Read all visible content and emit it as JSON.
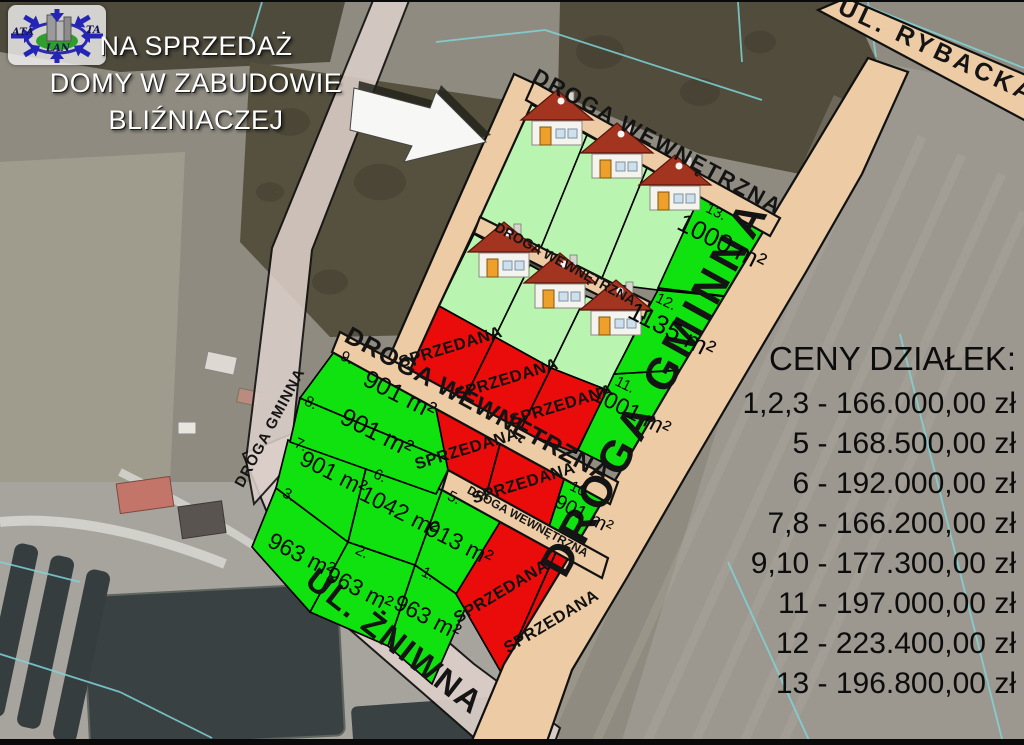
{
  "ad": {
    "line1": "NA SPRZEDAŻ",
    "line2": "DOMY W ZABUDOWIE",
    "line3": "BLIŹNIACZEJ"
  },
  "logo": {
    "ata": "ATA",
    "ta": "TA",
    "lan": "LAN"
  },
  "price_list": {
    "title": "CENY DZIAŁEK:",
    "items": [
      {
        "plots": "1,2,3",
        "price": "166.000,00 zł"
      },
      {
        "plots": "5",
        "price": "168.500,00 zł"
      },
      {
        "plots": "6",
        "price": "192.000,00 zł"
      },
      {
        "plots": "7,8",
        "price": "166.200,00 zł"
      },
      {
        "plots": "9,10",
        "price": "177.300,00 zł"
      },
      {
        "plots": "11",
        "price": "197.000,00 zł"
      },
      {
        "plots": "12",
        "price": "223.400,00 zł"
      },
      {
        "plots": "13",
        "price": "196.800,00 zł"
      }
    ]
  },
  "streets": [
    {
      "key": "zniwna",
      "name": "UL. ŻNIWNA"
    },
    {
      "key": "gminnaL",
      "name": "DROGA GMINNA"
    },
    {
      "key": "rybacka",
      "name": "UL. RYBACKA"
    },
    {
      "key": "gminnaR",
      "name": "DROGA GMINNA"
    },
    {
      "key": "rtop",
      "name": "DROGA WEWNĘTRZNA"
    },
    {
      "key": "r2",
      "name": "DROGA WEWNĘTRZNA"
    },
    {
      "key": "r3",
      "name": "DROGA WEWNĘTRZNA"
    },
    {
      "key": "r4",
      "name": "DROGA WEWNĘTRZNA"
    },
    {
      "key": "rleft",
      "name": ""
    }
  ],
  "sold_label": "SPRZEDANA",
  "plots": [
    {
      "id": "p1",
      "number": "1.",
      "area": "963 m²"
    },
    {
      "id": "p2",
      "number": "2.",
      "area": "963 m²"
    },
    {
      "id": "p3",
      "number": "3.",
      "area": "963 m²"
    },
    {
      "id": "p5",
      "number": "5.",
      "area": "913 m²"
    },
    {
      "id": "p6",
      "number": "6.",
      "area": "1042 m²"
    },
    {
      "id": "p7",
      "number": "7.",
      "area": "901 m²"
    },
    {
      "id": "p8",
      "number": "8.",
      "area": "901 m²"
    },
    {
      "id": "p9",
      "number": "9.",
      "area": "901 m²"
    },
    {
      "id": "p10",
      "number": "10.",
      "area": "901 m²"
    },
    {
      "id": "p11",
      "number": "11.",
      "area": "1001 m²"
    },
    {
      "id": "p12",
      "number": "12.",
      "area": "1135 m²"
    },
    {
      "id": "p13",
      "number": "13.",
      "area": "1000 m²"
    }
  ],
  "sold_plots": [
    {
      "id": "s1"
    },
    {
      "id": "s2"
    },
    {
      "id": "s3"
    },
    {
      "id": "s4"
    },
    {
      "id": "s5"
    },
    {
      "id": "s6"
    },
    {
      "id": "s7"
    }
  ],
  "colors": {
    "available": "#10e210",
    "sold": "#ea0b0b",
    "house_plot": "#b9f4b1",
    "road": "#edcba5",
    "road_light": "#dccfc9"
  }
}
